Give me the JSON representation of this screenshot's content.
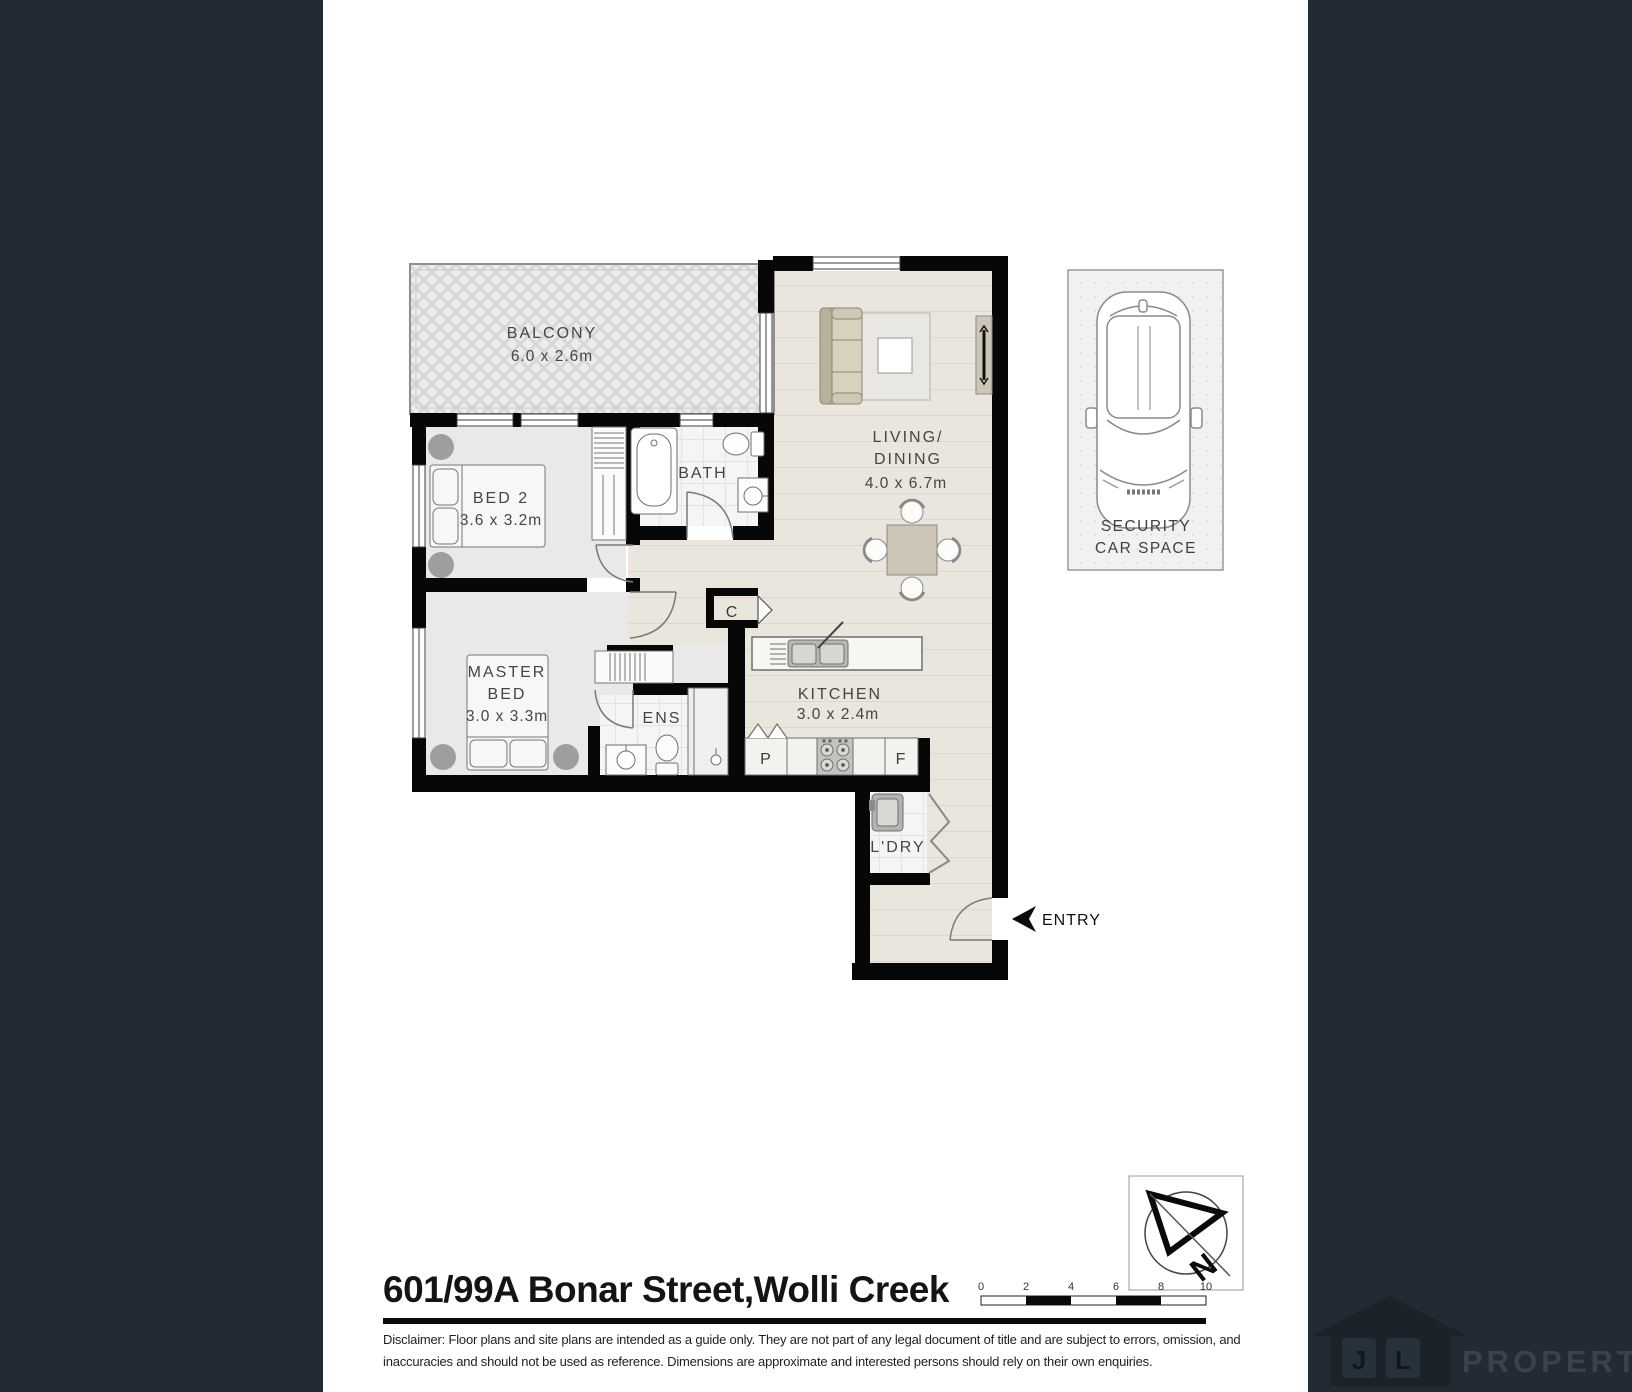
{
  "page": {
    "title": "601/99A Bonar Street,Wolli Creek",
    "disclaimer": {
      "line1": "Disclaimer: Floor plans and site plans are intended as a guide only. They are not part of any legal document of title and are subject to errors, omission, and",
      "line2": "inaccuracies and should not be used as reference. Dimensions are approximate and interested persons should rely on their own enquiries."
    }
  },
  "floorplan": {
    "balcony": {
      "name": "BALCONY",
      "dims": "6.0 x 2.6m"
    },
    "living": {
      "line1": "LIVING/",
      "line2": "DINING",
      "dims": "4.0 x 6.7m"
    },
    "bed2": {
      "name": "BED 2",
      "dims": "3.6 x 3.2m"
    },
    "bath": {
      "name": "BATH"
    },
    "master": {
      "line1": "MASTER",
      "line2": "BED",
      "dims": "3.0 x 3.3m"
    },
    "ens": {
      "name": "ENS"
    },
    "kitchen": {
      "name": "KITCHEN",
      "dims": "3.0 x 2.4m"
    },
    "laundry": {
      "name": "L'DRY"
    },
    "closet": "C",
    "pantry": "P",
    "fridge": "F",
    "entry": "ENTRY"
  },
  "car_space": {
    "line1": "SECURITY",
    "line2": "CAR SPACE"
  },
  "compass": {
    "letter": "N"
  },
  "scale_bar": {
    "labels": [
      "0",
      "2",
      "4",
      "6",
      "8",
      "10"
    ]
  },
  "logo": {
    "j": "J",
    "l": "L",
    "name": "PROPERTY"
  },
  "colors": {
    "sidebar": "#222b33",
    "wall": "#070707",
    "floor_plank": "#eae5dd",
    "floor_room": "#e9e9e7",
    "floor_tile": "#f4f5f4"
  }
}
